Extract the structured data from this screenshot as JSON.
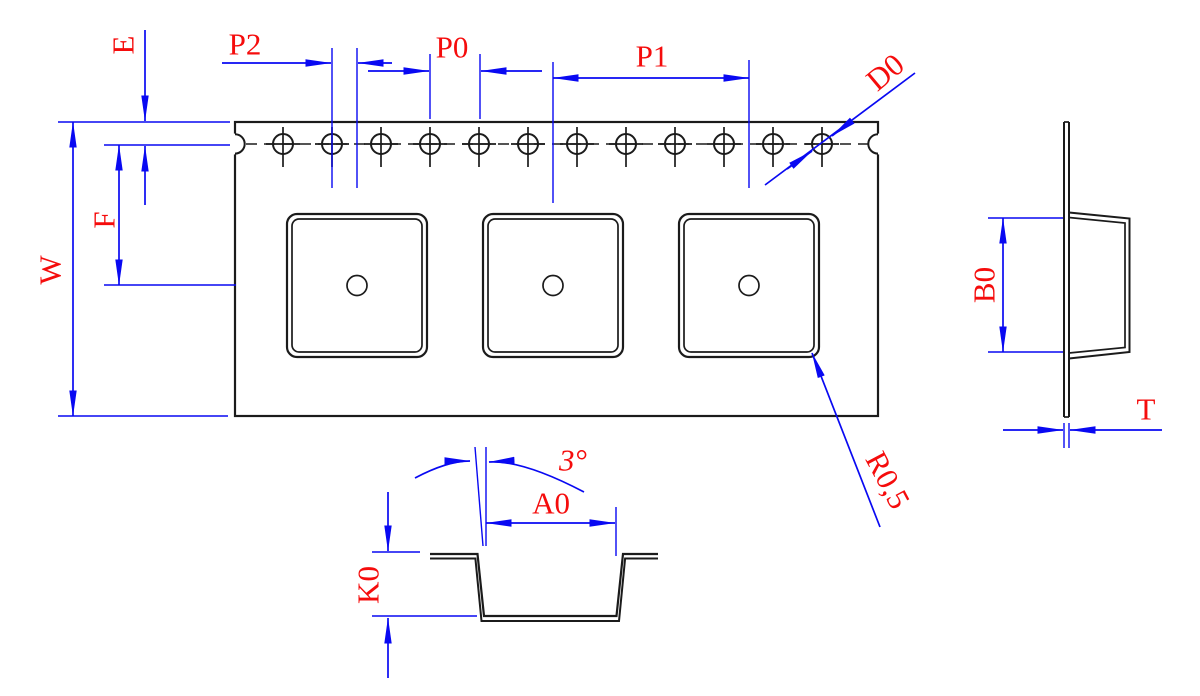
{
  "labels": {
    "e": "E",
    "p2": "P2",
    "p0": "P0",
    "p1": "P1",
    "d0": "D0",
    "w": "W",
    "f": "F",
    "b0": "B0",
    "t": "T",
    "k0": "K0",
    "a0": "A0",
    "draft_angle": "3°",
    "corner_radius": "R0,5"
  },
  "colors": {
    "dimension_blue": "#0909f2",
    "label_red": "#f50c0c",
    "line_black": "#1b1b1b",
    "background": "#ffffff"
  }
}
